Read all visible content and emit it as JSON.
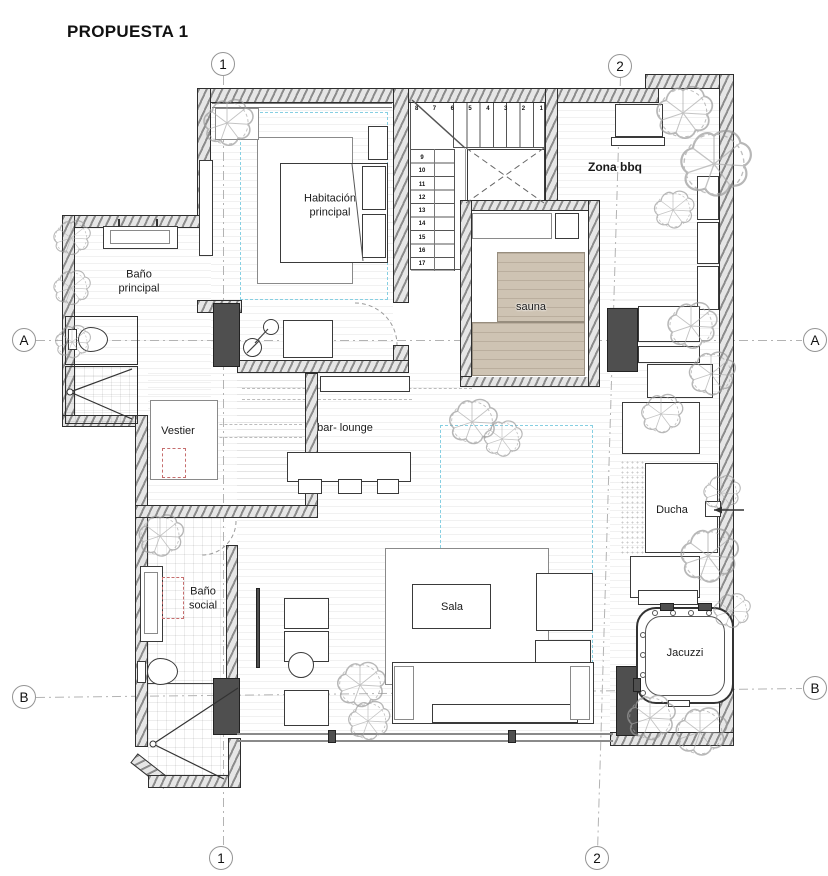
{
  "title": "PROPUESTA 1",
  "grid": {
    "col1": "1",
    "col2": "2",
    "rowA": "A",
    "rowB": "B"
  },
  "rooms": {
    "habitacion_principal": "Habitación principal",
    "bano_principal": "Baño principal",
    "zona_bbq": "Zona bbq",
    "sauna": "sauna",
    "vestier": "Vestier",
    "bar_lounge": "bar- lounge",
    "ducha": "Ducha",
    "bano_social": "Baño social",
    "sala": "Sala",
    "jacuzzi": "Jacuzzi"
  },
  "stairs": {
    "upper_run": [
      "8",
      "7",
      "6",
      "5",
      "4",
      "3",
      "2",
      "1"
    ],
    "lower_run": [
      "9",
      "10",
      "11",
      "12",
      "13",
      "14",
      "15",
      "16",
      "17"
    ]
  },
  "colors": {
    "sauna_bench": "#cec3b3",
    "zone_outline": "#86cfe2",
    "closet_outline": "#c66e6e",
    "wall_dark": "#4f4f4f"
  }
}
